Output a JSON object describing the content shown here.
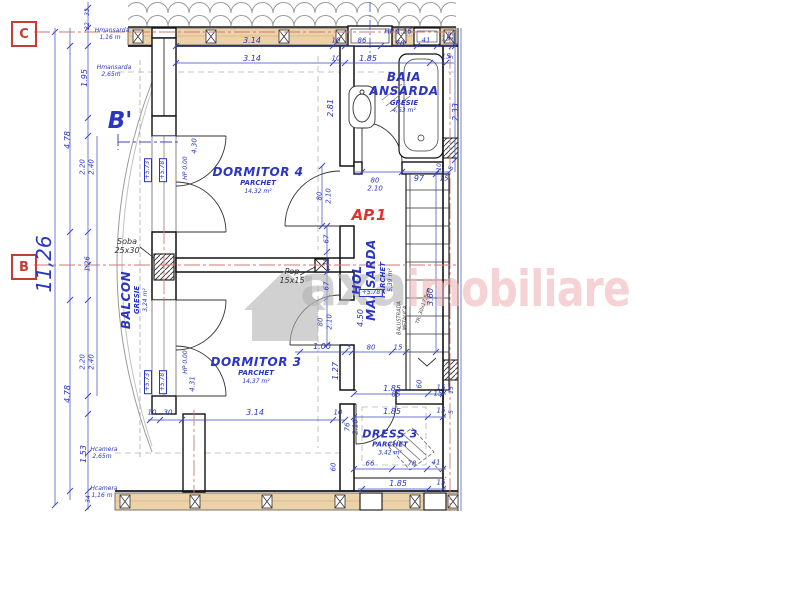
{
  "grid_markers": {
    "top": "C",
    "middle": "B"
  },
  "section_marker": "B'",
  "apartment_label": "AP.1",
  "watermark": {
    "gray": "axa",
    "pink": "imobiliare"
  },
  "rooms": {
    "dormitor4": {
      "name": "DORMITOR 4",
      "finish": "PARCHET",
      "area": "14,32 m²"
    },
    "dormitor3": {
      "name": "DORMITOR 3",
      "finish": "PARCHET",
      "area": "14,37 m²"
    },
    "baia": {
      "name_line1": "BAIA",
      "name_line2": "ANSARDA",
      "finish": "GRESIE",
      "area": "4,63 m²"
    },
    "hol": {
      "name_line1": "HOL",
      "name_line2": "MANSARDA",
      "finish": "PARCHET",
      "area": "5,39 m²"
    },
    "balcon": {
      "name": "BALCON",
      "finish": "GRESIE",
      "area": "3,24 m²"
    },
    "dress": {
      "name": "DRESS 3",
      "finish": "PARCHET",
      "area": "3,42 m²"
    }
  },
  "colors": {
    "dim_blue": "#2a35c0",
    "line_blue": "#3d49c4",
    "marker_red": "#c73b32",
    "axis_red": "#d07b72",
    "wall_tan": "#ecd2a9",
    "wm_gray": "#b3b3b3",
    "wm_pink": "#f0b5b8"
  },
  "labels": [
    {
      "t": "3.14",
      "x": 252,
      "y": 41
    },
    {
      "t": "10",
      "x": 336,
      "y": 41,
      "s": 7
    },
    {
      "t": "86",
      "x": 362,
      "y": 41,
      "s": 7
    },
    {
      "t": "78",
      "x": 400,
      "y": 44,
      "s": 7
    },
    {
      "t": "41",
      "x": 426,
      "y": 41,
      "s": 7
    },
    {
      "t": "15",
      "x": 446,
      "y": 39,
      "s": 7
    },
    {
      "t": "HP 1.16",
      "x": 398,
      "y": 32,
      "s": 7,
      "n": "skylight-hp-label"
    },
    {
      "t": "3.14",
      "x": 252,
      "y": 59
    },
    {
      "t": "10",
      "x": 336,
      "y": 59,
      "s": 7
    },
    {
      "t": "1.85",
      "x": 368,
      "y": 59
    },
    {
      "t": "15",
      "x": 446,
      "y": 57,
      "s": 7
    },
    {
      "t": "33",
      "x": 88,
      "y": 12,
      "r": -90,
      "s": 6
    },
    {
      "t": "32",
      "x": 88,
      "y": 26,
      "r": -90,
      "s": 6
    },
    {
      "t": "1.95",
      "x": 85,
      "y": 78,
      "r": -90
    },
    {
      "t": "4.78",
      "x": 68,
      "y": 140,
      "r": -90
    },
    {
      "t": "2.20",
      "x": 83,
      "y": 167,
      "r": -90,
      "s": 7
    },
    {
      "t": "2.40",
      "x": 92,
      "y": 167,
      "r": -90,
      "s": 7
    },
    {
      "t": "11,26",
      "x": 44,
      "y": 264,
      "r": -90,
      "s": 20,
      "n": "overall-dim"
    },
    {
      "t": "1.26",
      "x": 88,
      "y": 264,
      "r": -90,
      "s": 7
    },
    {
      "t": "2.20",
      "x": 83,
      "y": 362,
      "r": -90,
      "s": 7
    },
    {
      "t": "2.40",
      "x": 92,
      "y": 362,
      "r": -90,
      "s": 7
    },
    {
      "t": "4.78",
      "x": 68,
      "y": 394,
      "r": -90
    },
    {
      "t": "1.53",
      "x": 84,
      "y": 454,
      "r": -90
    },
    {
      "t": "34",
      "x": 89,
      "y": 499,
      "r": -90,
      "s": 6
    },
    {
      "t": "Hmansarda",
      "x": 112,
      "y": 31,
      "s": 6,
      "n": "height-note"
    },
    {
      "t": "1,16 m",
      "x": 110,
      "y": 38,
      "s": 6
    },
    {
      "t": "Hmansarda",
      "x": 114,
      "y": 68,
      "s": 6,
      "n": "height-note"
    },
    {
      "t": "2,65m",
      "x": 111,
      "y": 75,
      "s": 6
    },
    {
      "t": "Hcamera",
      "x": 104,
      "y": 450,
      "s": 6,
      "n": "height-note"
    },
    {
      "t": "2,65m",
      "x": 102,
      "y": 457,
      "s": 6
    },
    {
      "t": "Hcamera",
      "x": 104,
      "y": 489,
      "s": 6,
      "n": "height-note"
    },
    {
      "t": "1,16 m",
      "x": 102,
      "y": 496,
      "s": 6
    },
    {
      "t": "+5.73",
      "x": 148,
      "y": 170,
      "r": -90,
      "s": 6,
      "box": true,
      "n": "level-marker"
    },
    {
      "t": "+5.78",
      "x": 163,
      "y": 170,
      "r": -90,
      "s": 6,
      "box": true,
      "n": "level-marker"
    },
    {
      "t": "+5.73",
      "x": 148,
      "y": 382,
      "r": -90,
      "s": 6,
      "box": true,
      "n": "level-marker"
    },
    {
      "t": "+5.78",
      "x": 163,
      "y": 382,
      "r": -90,
      "s": 6,
      "box": true,
      "n": "level-marker"
    },
    {
      "t": "+5.78",
      "x": 371,
      "y": 293,
      "s": 6,
      "box": true,
      "n": "level-marker"
    },
    {
      "t": "HP 0.00",
      "x": 186,
      "y": 168,
      "r": -90,
      "s": 6
    },
    {
      "t": "4.30",
      "x": 195,
      "y": 146,
      "r": -90,
      "s": 7
    },
    {
      "t": "HP 0.00",
      "x": 186,
      "y": 362,
      "r": -90,
      "s": 6
    },
    {
      "t": "4.31",
      "x": 193,
      "y": 384,
      "r": -90,
      "s": 7
    },
    {
      "t": "Soba",
      "x": 127,
      "y": 242,
      "c": "#333",
      "n": "soba-label"
    },
    {
      "t": "25x30",
      "x": 127,
      "y": 251,
      "c": "#333",
      "n": "soba-size"
    },
    {
      "t": "Pop",
      "x": 292,
      "y": 272,
      "c": "#333",
      "n": "pop-label"
    },
    {
      "t": "15x15",
      "x": 292,
      "y": 281,
      "c": "#333",
      "n": "pop-size"
    },
    {
      "t": "2.81",
      "x": 331,
      "y": 108,
      "r": -90
    },
    {
      "t": "80",
      "x": 320,
      "y": 196,
      "r": -90,
      "s": 7
    },
    {
      "t": "2.10",
      "x": 329,
      "y": 196,
      "r": -90,
      "s": 7
    },
    {
      "t": "67",
      "x": 327,
      "y": 239,
      "r": -90,
      "s": 7
    },
    {
      "t": "15",
      "x": 327,
      "y": 262,
      "r": -90,
      "s": 6
    },
    {
      "t": "67",
      "x": 327,
      "y": 286,
      "r": -90,
      "s": 7
    },
    {
      "t": "80",
      "x": 321,
      "y": 322,
      "r": -90,
      "s": 7
    },
    {
      "t": "2.10",
      "x": 330,
      "y": 322,
      "r": -90,
      "s": 7
    },
    {
      "t": "1.27",
      "x": 336,
      "y": 371,
      "r": -90
    },
    {
      "t": "76",
      "x": 348,
      "y": 427,
      "r": -90,
      "s": 7
    },
    {
      "t": "2.10",
      "x": 356,
      "y": 427,
      "r": -90,
      "s": 7
    },
    {
      "t": "60",
      "x": 334,
      "y": 467,
      "r": -90,
      "s": 7
    },
    {
      "t": "80",
      "x": 375,
      "y": 181,
      "s": 7
    },
    {
      "t": "2.10",
      "x": 375,
      "y": 189,
      "s": 7
    },
    {
      "t": "97",
      "x": 419,
      "y": 179
    },
    {
      "t": "15",
      "x": 444,
      "y": 179,
      "s": 7
    },
    {
      "t": "10",
      "x": 440,
      "y": 167,
      "r": -90,
      "s": 6
    },
    {
      "t": "2.33",
      "x": 456,
      "y": 112,
      "r": -90
    },
    {
      "t": "1.00",
      "x": 322,
      "y": 347
    },
    {
      "t": "5",
      "x": 349,
      "y": 348,
      "s": 6
    },
    {
      "t": "80",
      "x": 371,
      "y": 348,
      "s": 7
    },
    {
      "t": "15",
      "x": 398,
      "y": 348,
      "s": 7
    },
    {
      "t": "4.50",
      "x": 361,
      "y": 318,
      "r": -90
    },
    {
      "t": "3.60",
      "x": 431,
      "y": 297,
      "r": -90
    },
    {
      "t": "60",
      "x": 420,
      "y": 384,
      "r": -90,
      "s": 7
    },
    {
      "t": "85",
      "x": 396,
      "y": 395,
      "s": 7
    },
    {
      "t": "15",
      "x": 438,
      "y": 394,
      "s": 7
    },
    {
      "t": "BALUSTRADA",
      "x": 400,
      "y": 318,
      "r": -90,
      "s": 5,
      "c": "#444",
      "n": "balustrade-note"
    },
    {
      "t": "METALICA",
      "x": 406,
      "y": 318,
      "r": -90,
      "s": 5,
      "c": "#444",
      "n": "balustrade-note"
    },
    {
      "t": "TR. 30x17,5cm",
      "x": 424,
      "y": 306,
      "r": -72,
      "s": 5,
      "c": "#444",
      "n": "stair-tread-note"
    },
    {
      "t": "10",
      "x": 152,
      "y": 413,
      "s": 7
    },
    {
      "t": "30",
      "x": 168,
      "y": 413,
      "s": 7
    },
    {
      "t": "3.14",
      "x": 255,
      "y": 413
    },
    {
      "t": "10",
      "x": 338,
      "y": 413,
      "s": 7
    },
    {
      "t": "1.85",
      "x": 392,
      "y": 389
    },
    {
      "t": "15",
      "x": 441,
      "y": 388,
      "s": 7
    },
    {
      "t": "1.85",
      "x": 392,
      "y": 412
    },
    {
      "t": "15",
      "x": 441,
      "y": 411,
      "s": 7
    },
    {
      "t": "66",
      "x": 370,
      "y": 464,
      "s": 7
    },
    {
      "t": "78",
      "x": 412,
      "y": 464,
      "s": 7
    },
    {
      "t": "41",
      "x": 436,
      "y": 463,
      "s": 7
    },
    {
      "t": "1.85",
      "x": 398,
      "y": 484
    },
    {
      "t": "15",
      "x": 441,
      "y": 483,
      "s": 7
    },
    {
      "t": "15",
      "x": 452,
      "y": 36,
      "r": -90,
      "s": 6
    },
    {
      "t": "5",
      "x": 452,
      "y": 57,
      "r": -90,
      "s": 6
    },
    {
      "t": "5",
      "x": 452,
      "y": 168,
      "r": -90,
      "s": 6
    },
    {
      "t": "15",
      "x": 452,
      "y": 390,
      "r": -90,
      "s": 6
    },
    {
      "t": "5",
      "x": 452,
      "y": 412,
      "r": -90,
      "s": 6
    }
  ]
}
